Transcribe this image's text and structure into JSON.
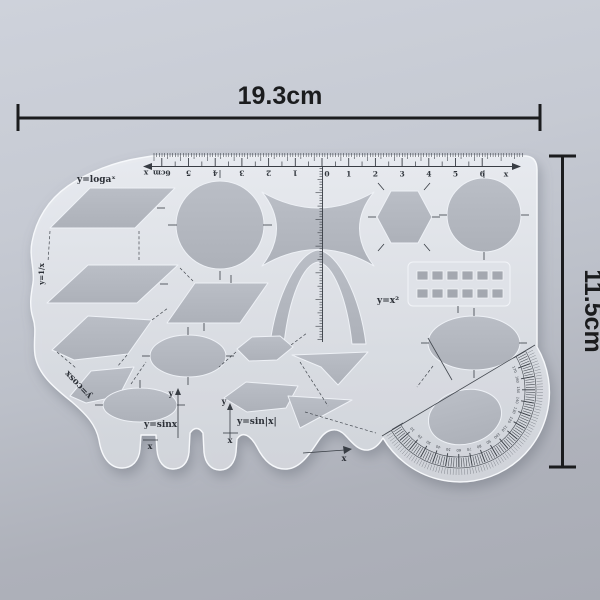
{
  "product": {
    "description": "transparent multi-shape geometry template ruler",
    "plastic_color": "#e0e3e9",
    "hole_color": "#b4b8c0",
    "ink_color": "#383d44",
    "dimension_color": "#1b1c1e"
  },
  "dimensions": {
    "width_label": "19.3cm",
    "height_label": "11.5cm"
  },
  "ruler": {
    "left_labels": [
      "6cm",
      "5",
      "4",
      "3",
      "2",
      "1"
    ],
    "zero_label": "0",
    "right_labels": [
      "1",
      "2",
      "3",
      "4",
      "5",
      "6"
    ],
    "left_axis_label": "x",
    "right_axis_label": "x"
  },
  "formulas": {
    "log": "y=logaˣ",
    "reciprocal": "y=1/x",
    "cos": "y=cosx",
    "sin": "y=sinx",
    "sin_abs": "y=sin|x|",
    "square": "y=x²"
  },
  "axes": {
    "y_label": "y",
    "x_label": "x"
  },
  "protractor": {
    "labels": [
      "10",
      "20",
      "30",
      "40",
      "50",
      "60",
      "70",
      "80",
      "90",
      "100",
      "110",
      "120",
      "130",
      "140",
      "150",
      "160",
      "170"
    ]
  }
}
